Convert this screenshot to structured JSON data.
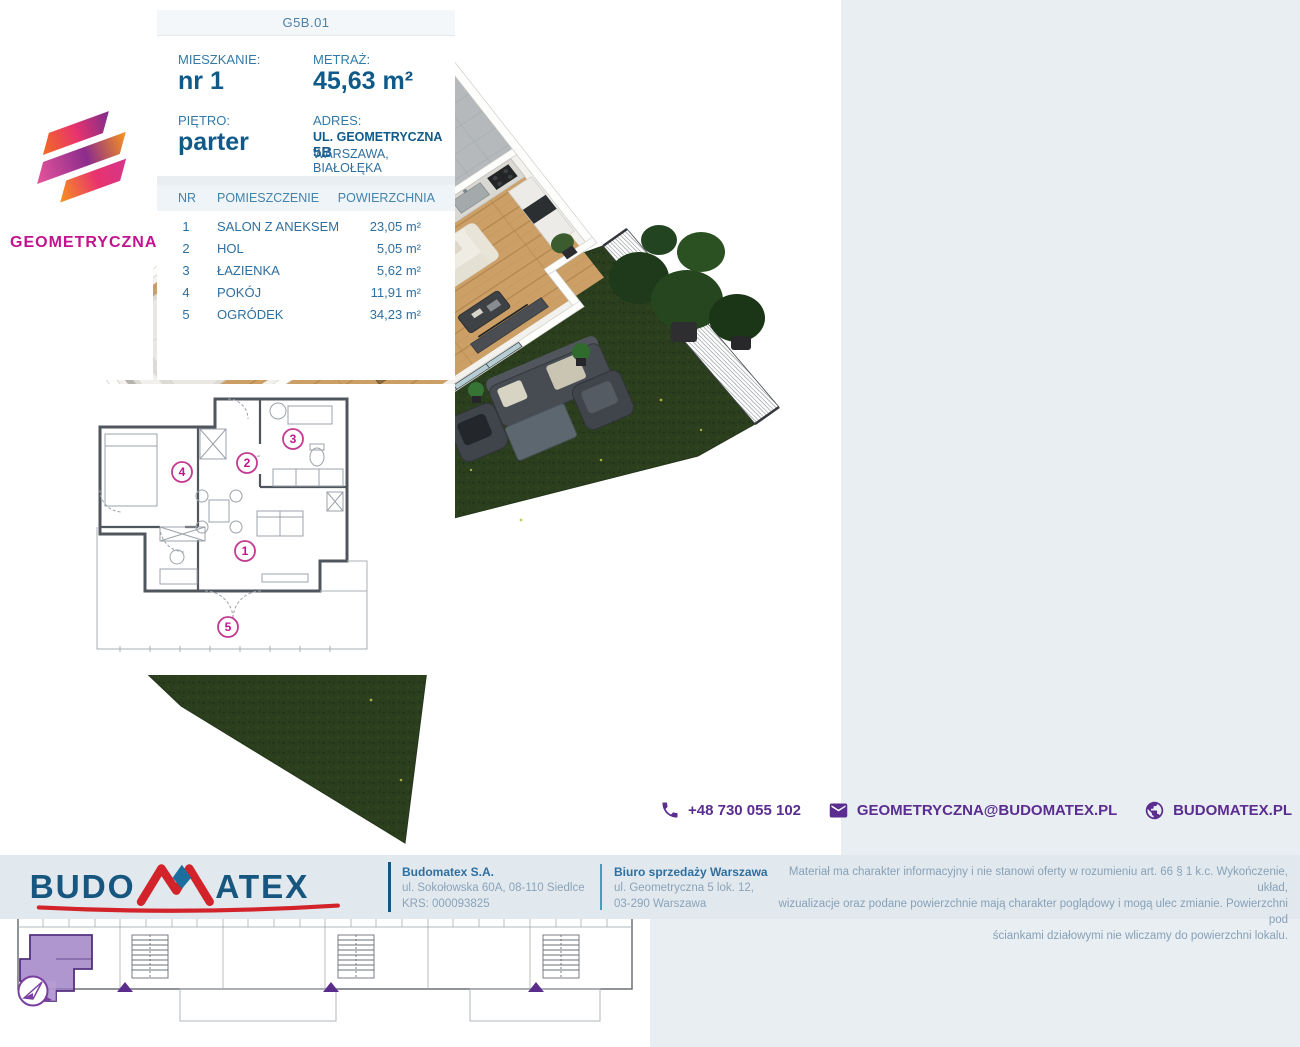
{
  "page": {
    "background": "#e8eef2",
    "accent_blue": "#0f5a89",
    "accent_purple": "#5b2d90",
    "accent_magenta": "#c2138f",
    "accent_red": "#d2232a"
  },
  "unit_header": {
    "code": "G5B.01"
  },
  "brand": {
    "name": "GEOMETRYCZNA"
  },
  "info": {
    "fields": [
      {
        "label": "MIESZKANIE:",
        "value": "nr 1"
      },
      {
        "label": "METRAŻ:",
        "value": "45,63 m²"
      },
      {
        "label": "PIĘTRO:",
        "value": "parter"
      },
      {
        "label": "ADRES:",
        "value_line1": "UL. GEOMETRYCZNA",
        "value_number": "5B",
        "value_line2": "WARSZAWA, BIAŁOŁĘKA"
      }
    ]
  },
  "rooms": {
    "headers": [
      "NR",
      "POMIESZCZENIE",
      "POWIERZCHNIA"
    ],
    "rows": [
      {
        "nr": "1",
        "name": "SALON Z ANEKSEM",
        "area": "23,05 m²"
      },
      {
        "nr": "2",
        "name": "HOL",
        "area": "5,05 m²"
      },
      {
        "nr": "3",
        "name": "ŁAZIENKA",
        "area": "5,62 m²"
      },
      {
        "nr": "4",
        "name": "POKÓJ",
        "area": "11,91 m²"
      },
      {
        "nr": "5",
        "name": "OGRÓDEK",
        "area": "34,23 m²"
      }
    ]
  },
  "contact": {
    "phone": "+48 730 055 102",
    "email": "GEOMETRYCZNA@BUDOMATEX.PL",
    "website": "BUDOMATEX.PL"
  },
  "footer": {
    "logo_part1": "BUDO",
    "logo_part2": "ATEX",
    "company": {
      "name": "Budomatex S.A.",
      "address": "ul. Sokołowska 60A, 08-110 Siedlce",
      "krs": "KRS: 000093825"
    },
    "office": {
      "name": "Biuro sprzedaży Warszawa",
      "address_line1": "ul. Geometryczna 5 lok. 12,",
      "address_line2": "03-290 Warszawa"
    },
    "disclaimer_lines": [
      "Materiał ma charakter informacyjny i nie stanowi oferty w rozumieniu art. 66 § 1 k.c. Wykończenie, układ,",
      "wizualizacje oraz podane powierzchnie mają charakter poglądowy i mogą ulec zmianie. Powierzchni pod",
      "ściankami działowymi nie wliczamy do powierzchni lokalu."
    ]
  },
  "icons": {
    "phone": "phone-icon",
    "email": "envelope-icon",
    "website": "globe-icon",
    "compass": "compass-north-icon",
    "logo": "geometryczna-hexagon-logo"
  }
}
